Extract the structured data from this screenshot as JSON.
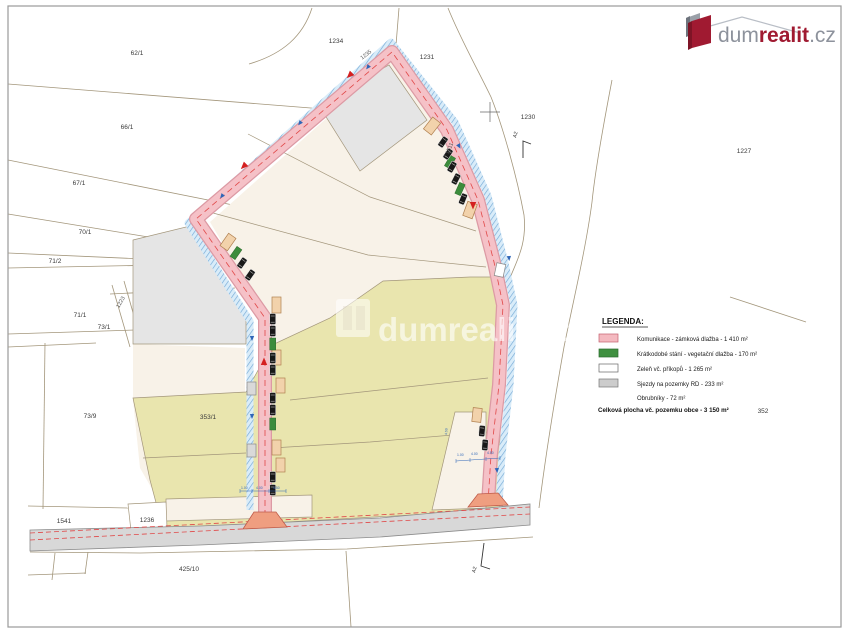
{
  "page": {
    "background": "#ffffff",
    "border_color": "#9a9a9a"
  },
  "logo": {
    "dum": "dum",
    "realit": "realit",
    "cz": ".cz",
    "gray": "#8d929c",
    "red": "#a01a31"
  },
  "watermark": {
    "text": "dumrealit.cz"
  },
  "legend": {
    "title": "LEGENDA:",
    "items": [
      {
        "color": "#f4b9c0",
        "label": "Komunikace - zámková dlažba - 1 410 m²"
      },
      {
        "color": "#3f9040",
        "label": "Krátkodobé stání - vegetační dlažba - 170 m²"
      },
      {
        "color": "#ffffff",
        "label": "Zeleň vč. příkopů - 1 265 m²"
      },
      {
        "color": "#cccccc",
        "label": "Sjezdy na pozemky RD - 233 m²"
      }
    ],
    "item_no_swatch": "Obrubníky - 72 m²",
    "total": "Celková plocha vč. pozemku obce - 3 150 m²"
  },
  "labels": {
    "p62_1": "62/1",
    "p66_1": "66/1",
    "p67_1": "67/1",
    "p70_1": "70/1",
    "p71_2": "71/2",
    "p71_1": "71/1",
    "p73_1": "73/1",
    "p73_9": "73/9",
    "p353_1": "353/1",
    "p1541": "1541",
    "p1236": "1236",
    "p425_10": "425/10",
    "p1234": "1234",
    "p1231": "1231",
    "p1230": "1230",
    "p1227": "1227",
    "p352": "352",
    "p1223": "1223",
    "p1235": "1235",
    "p1511": "1511"
  },
  "annotations": {
    "section_marker": "A2",
    "dim_small": "1.00",
    "dim_mid": "4.00",
    "dim_large": "4.50"
  }
}
